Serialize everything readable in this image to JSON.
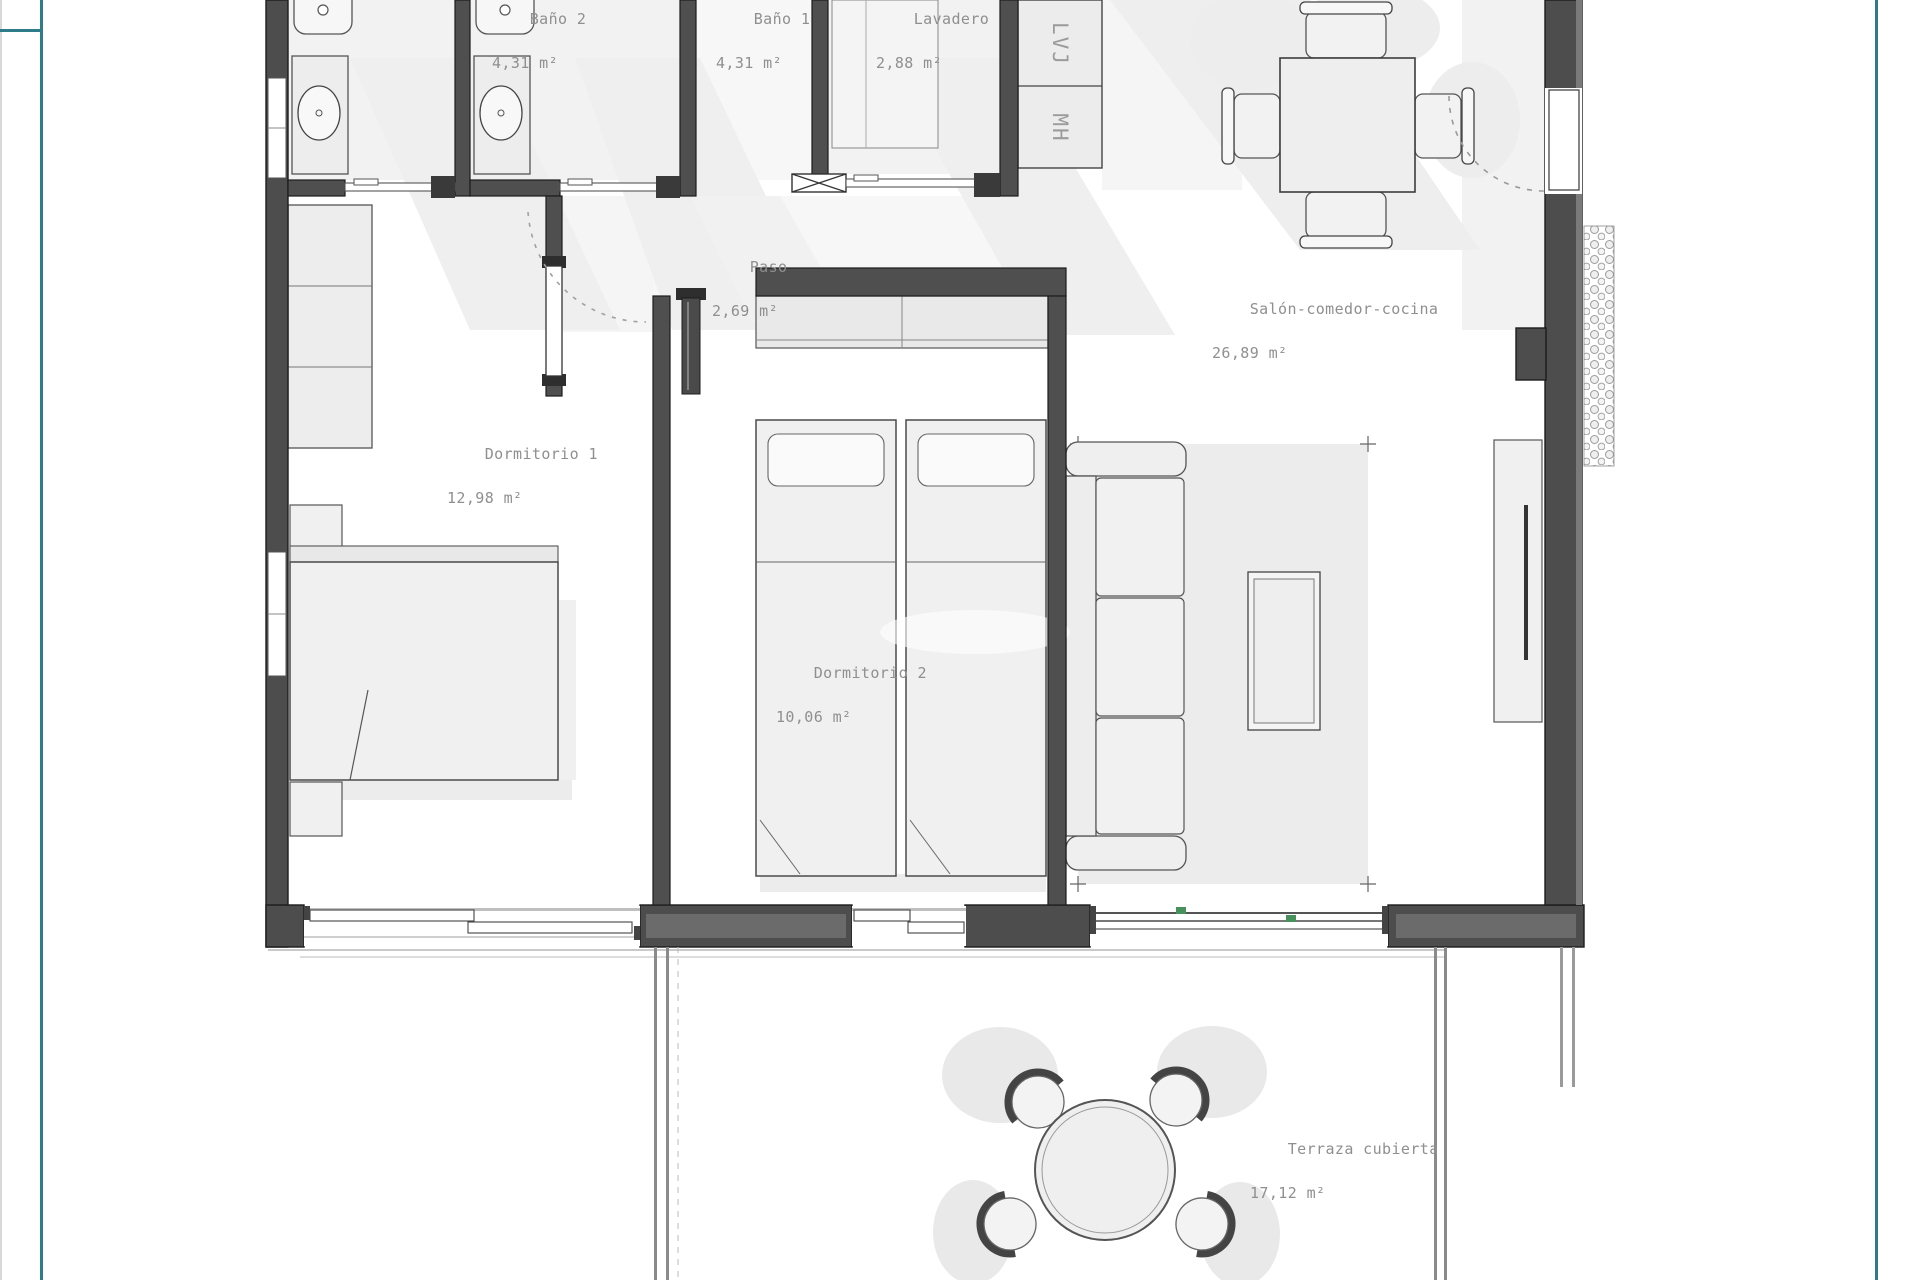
{
  "plan_title": "Apartment floor plan",
  "rooms": [
    {
      "id": "bano2",
      "name": "Baño 2",
      "area": "4,31 m²"
    },
    {
      "id": "bano1",
      "name": "Baño 1",
      "area": "4,31 m²"
    },
    {
      "id": "lavadero",
      "name": "Lavadero",
      "area": "2,88 m²"
    },
    {
      "id": "paso",
      "name": "Paso",
      "area": "2,69 m²"
    },
    {
      "id": "salon",
      "name": "Salón-comedor-cocina",
      "area": "26,89 m²"
    },
    {
      "id": "dormitorio1",
      "name": "Dormitorio 1",
      "area": "12,98 m²"
    },
    {
      "id": "dormitorio2",
      "name": "Dormitorio 2",
      "area": "10,06 m²"
    },
    {
      "id": "terraza",
      "name": "Terraza cubierta",
      "area": "17,12 m²"
    }
  ],
  "kitchen_appliances": {
    "dishwasher_label": "LVJ",
    "micro_oven_label": "MH"
  },
  "colors": {
    "sheet_border_teal": "#2e7b8a",
    "wall_dark": "#4d4d4d",
    "label_text": "#8f8f8f",
    "window_hardware_green": "#46915c"
  }
}
